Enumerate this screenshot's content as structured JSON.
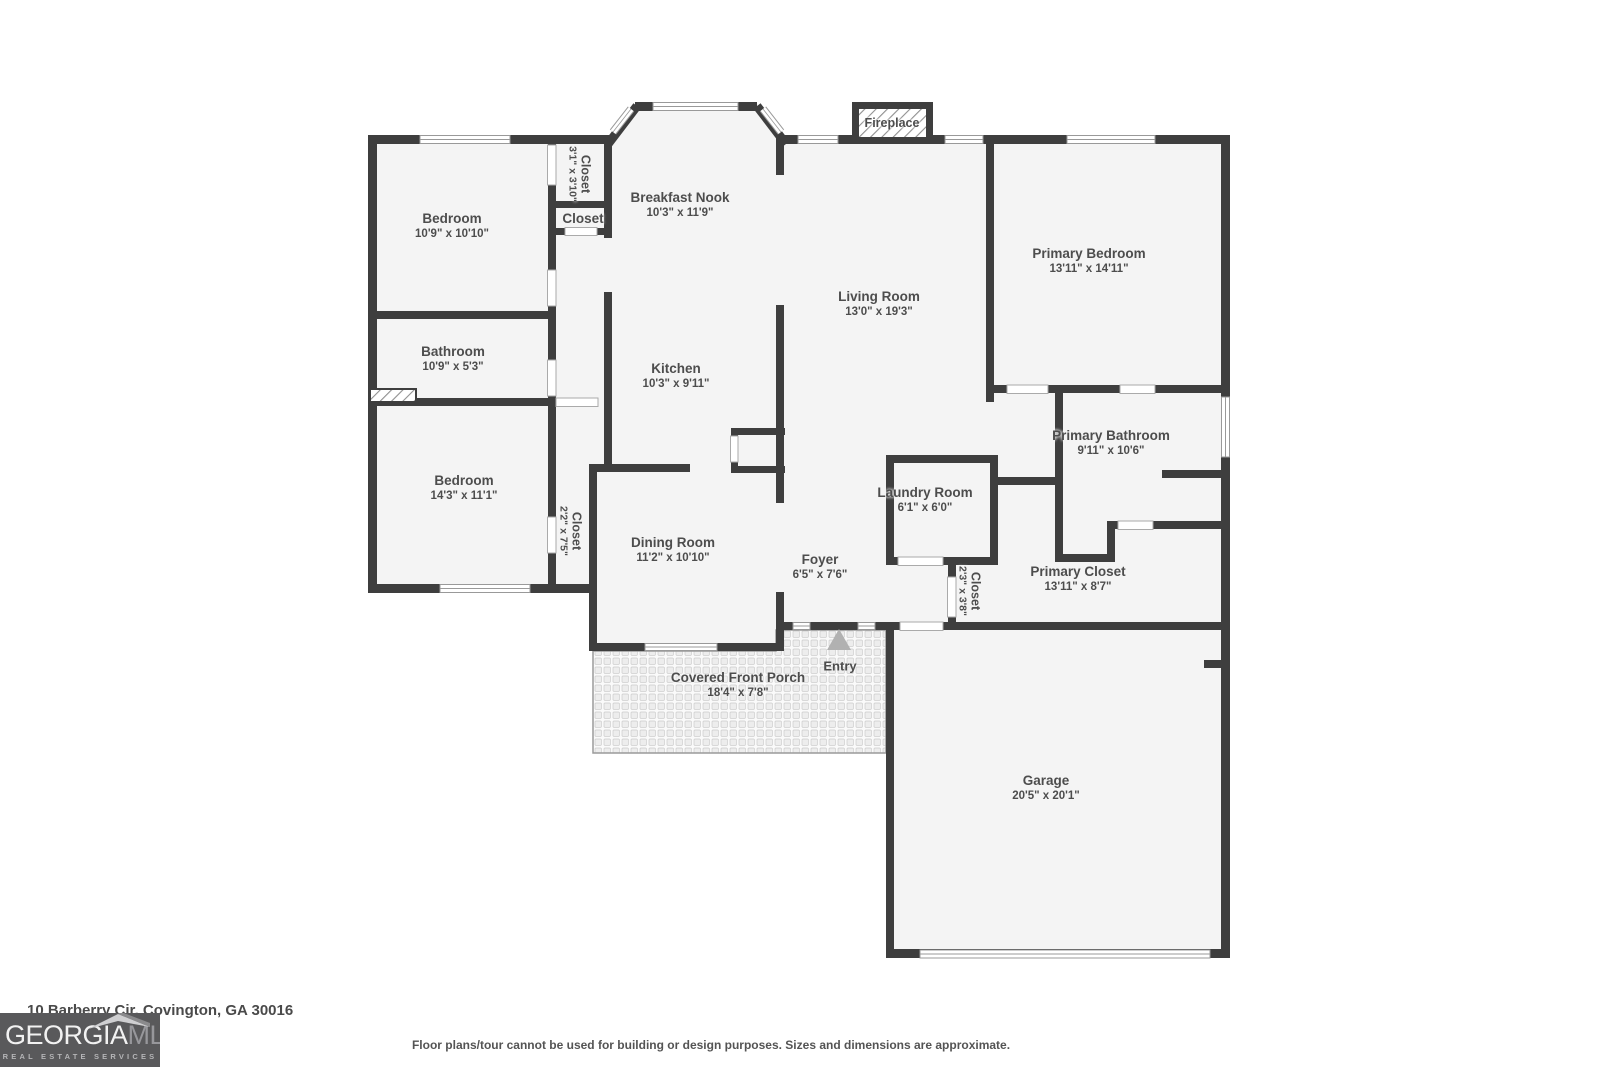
{
  "address": "10 Barberry Cir, Covington, GA 30016",
  "disclaimer": "Floor plans/tour cannot be used for building or design purposes. Sizes and dimensions are approximate.",
  "logo": {
    "brand_primary": "GEORGIA",
    "brand_secondary": "MLS",
    "tagline": "REAL ESTATE SERVICES"
  },
  "colors": {
    "wall": "#3e3e3e",
    "room_fill": "#f4f4f4",
    "label_text": "#4d4d4d",
    "logo_bg": "#59595b",
    "glyph_outline": "#999999",
    "entry_arrow": "#b1b1b1"
  },
  "rooms": {
    "bedroom1": {
      "name": "Bedroom",
      "dims": "10'9\" x 10'10\""
    },
    "closet1": {
      "name": "Closet",
      "dims": "3'1\" x 3'10\""
    },
    "closet2": {
      "name": "Closet"
    },
    "breakfast_nook": {
      "name": "Breakfast Nook",
      "dims": "10'3\" x 11'9\""
    },
    "living_room": {
      "name": "Living Room",
      "dims": "13'0\" x 19'3\""
    },
    "primary_bedroom": {
      "name": "Primary Bedroom",
      "dims": "13'11\" x 14'11\""
    },
    "bathroom": {
      "name": "Bathroom",
      "dims": "10'9\" x 5'3\""
    },
    "kitchen": {
      "name": "Kitchen",
      "dims": "10'3\" x 9'11\""
    },
    "bedroom2": {
      "name": "Bedroom",
      "dims": "14'3\" x 11'1\""
    },
    "closet3": {
      "name": "Closet",
      "dims": "2'2\" x 7'5\""
    },
    "dining_room": {
      "name": "Dining Room",
      "dims": "11'2\" x 10'10\""
    },
    "foyer": {
      "name": "Foyer",
      "dims": "6'5\" x 7'6\""
    },
    "laundry_room": {
      "name": "Laundry Room",
      "dims": "6'1\" x 6'0\""
    },
    "primary_bathroom": {
      "name": "Primary Bathroom",
      "dims": "9'11\" x 10'6\""
    },
    "closet4": {
      "name": "Closet",
      "dims": "2'3\" x 3'8\""
    },
    "primary_closet": {
      "name": "Primary Closet",
      "dims": "13'11\" x 8'7\""
    },
    "porch": {
      "name": "Covered Front Porch",
      "dims": "18'4\" x 7'8\""
    },
    "garage": {
      "name": "Garage",
      "dims": "20'5\" x 20'1\""
    },
    "fireplace": {
      "name": "Fireplace"
    },
    "entry": {
      "name": "Entry"
    }
  }
}
